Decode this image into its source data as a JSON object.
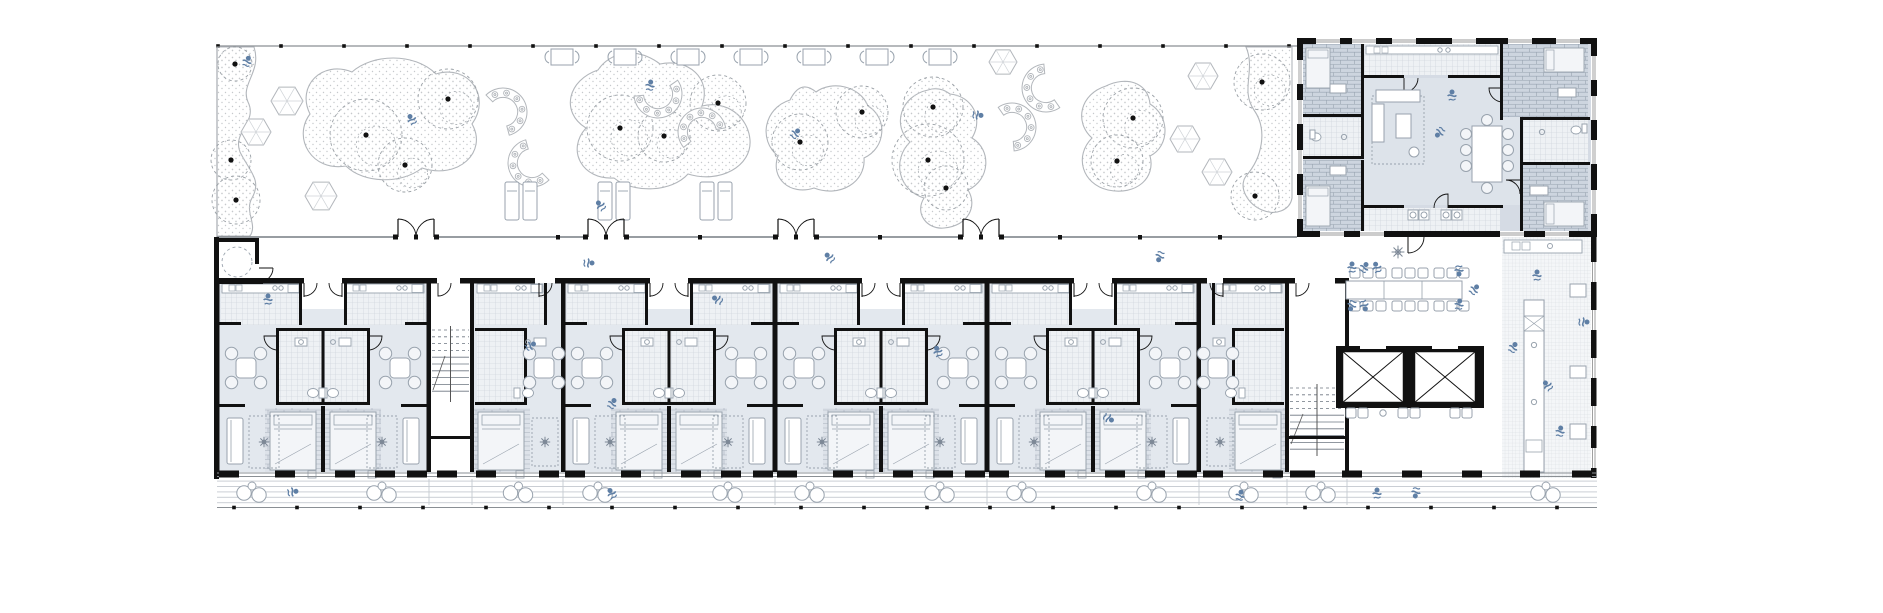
{
  "meta": {
    "drawing_type": "architectural-floor-plan",
    "storeys": "ground floor",
    "visible_text": ""
  },
  "palette": {
    "paper": "#ffffff",
    "wall": "#111111",
    "thin_line": "#8a8f94",
    "garden_line": "#b2b6bb",
    "tree_line": "#9aa0a6",
    "stipple_dot": "#c6c9cc",
    "unit_floor": "#e3e8ee",
    "tile_floor": "#eef1f4",
    "tile_grid": "#c7cdd6",
    "fine_grid": "#d6dade",
    "brick_line": "#a8b1bc",
    "brick_bg": "#dde2e9",
    "block_floor": "#d5dbe4",
    "block_brick_bg": "#cdd5df",
    "block_brick_line": "#98a3b0",
    "furniture": "#98a2ad",
    "person": "#5f7fa5",
    "deck_line": "#c5cad0"
  },
  "garden": {
    "bounds": {
      "x": 217,
      "y": 46,
      "x2": 1297,
      "y2": 237
    },
    "beds": [
      "M217,47 L254,47 C262,72 240,84 248,102 C258,122 232,132 240,152 C250,172 262,180 252,198 C244,212 258,224 250,236 L217,236 Z",
      "M352,72 C322,60 296,86 310,114 C292,138 312,172 346,166 C364,184 402,184 422,168 C458,180 488,152 472,124 C492,96 468,64 436,74 C414,52 372,54 352,72 Z",
      "M598,70 C568,80 560,112 586,128 C566,150 582,180 614,178 C634,194 672,192 688,174 C720,184 752,166 750,140 C748,116 726,100 702,106 C712,78 688,58 660,64 C636,46 610,52 598,70 Z",
      "M790,100 C764,108 758,140 778,156 C770,178 790,196 814,188 C840,198 866,182 864,158 C886,148 888,118 868,106 C860,86 832,80 816,92 C804,82 796,88 790,100 Z",
      "M928,90 C900,96 892,126 910,142 C892,160 898,190 924,198 C914,214 928,230 944,228 C968,226 978,206 968,190 C990,180 992,150 972,138 C984,118 972,96 950,94 C942,88 934,88 928,90 Z",
      "M1106,86 C1080,94 1074,122 1092,138 C1074,156 1082,184 1108,190 C1136,196 1156,178 1150,156 C1170,146 1170,116 1150,104 C1148,82 1126,76 1106,86 Z",
      "M1246,47 C1256,70 1240,90 1254,110 C1268,130 1262,158 1246,176 C1238,188 1248,204 1262,210 C1276,216 1290,210 1292,198 L1292,47 Z"
    ],
    "trees": [
      [
        235,
        64,
        17
      ],
      [
        231,
        160,
        20
      ],
      [
        236,
        200,
        24
      ],
      [
        366,
        135,
        36
      ],
      [
        448,
        99,
        30
      ],
      [
        405,
        165,
        27
      ],
      [
        620,
        128,
        33
      ],
      [
        664,
        136,
        26
      ],
      [
        718,
        103,
        28
      ],
      [
        800,
        142,
        28
      ],
      [
        862,
        112,
        26
      ],
      [
        933,
        107,
        30
      ],
      [
        928,
        160,
        36
      ],
      [
        946,
        188,
        22
      ],
      [
        1133,
        118,
        30
      ],
      [
        1117,
        161,
        26
      ],
      [
        1262,
        82,
        28
      ],
      [
        1255,
        196,
        24
      ]
    ],
    "hexes": [
      [
        287,
        101,
        16
      ],
      [
        256,
        132,
        15
      ],
      [
        321,
        196,
        16
      ],
      [
        1003,
        62,
        14
      ],
      [
        1203,
        76,
        15
      ],
      [
        1185,
        139,
        15
      ],
      [
        1217,
        172,
        15
      ]
    ],
    "benches": [
      [
        503,
        112,
        -40
      ],
      [
        532,
        163,
        140
      ],
      [
        658,
        94,
        60
      ],
      [
        702,
        132,
        235
      ],
      [
        1012,
        127,
        -30
      ],
      [
        1046,
        88,
        150
      ]
    ],
    "top_tables": {
      "y": 57,
      "xs": [
        562,
        625,
        688,
        751,
        814,
        877,
        940
      ]
    },
    "loungers": [
      [
        505,
        182
      ],
      [
        598,
        182
      ],
      [
        700,
        182
      ]
    ],
    "top_ticks": {
      "y": 46,
      "start": 218,
      "step": 63,
      "end": 1290
    }
  },
  "corridor": {
    "wall_y": 237,
    "door_xs": [
      416,
      606,
      796,
      981
    ],
    "tick_xs": [
      558,
      700,
      880,
      1060,
      1140,
      1220
    ]
  },
  "units": {
    "pair_cx": [
      323,
      669,
      881,
      1093
    ],
    "half_units": [
      {
        "x": 472,
        "w": 91,
        "side": "L"
      },
      {
        "x": 1199,
        "w": 88,
        "side": "R"
      }
    ],
    "stairs": [
      {
        "x": 429,
        "w": 43
      },
      {
        "x": 1287,
        "w": 60
      }
    ],
    "wc_room": {
      "x": 217,
      "y": 238,
      "w": 42,
      "h": 46
    }
  },
  "core": {
    "elevators": {
      "x": 1336,
      "y": 346,
      "w": 148,
      "h": 62
    },
    "bench_row": {
      "y": 408,
      "pairs": [
        1346,
        1398,
        1450
      ]
    },
    "communal_table": {
      "x": 1346,
      "y": 281,
      "w": 116,
      "h": 18,
      "chair_xs": [
        1350,
        1363,
        1376,
        1392,
        1405,
        1418,
        1434,
        1447,
        1459
      ],
      "top_y": 268,
      "bot_y": 301
    },
    "plant_xy": [
      1398,
      252
    ],
    "cafe": {
      "x": 1502,
      "y": 237,
      "w": 91,
      "h": 241,
      "wall_gap_ys": [
        262,
        310,
        358,
        406,
        448
      ]
    }
  },
  "amenity_block": {
    "x": 1297,
    "y": 38,
    "w": 300,
    "h": 199,
    "top_gap_xs": [
      1316,
      1352,
      1392,
      1452,
      1508,
      1556
    ],
    "bottom_gap_xs": [
      1320,
      1360,
      1500,
      1545
    ],
    "left_gap_ys": [
      60,
      100,
      150,
      195
    ],
    "right_gap_ys": [
      56,
      96,
      140,
      190
    ],
    "washer_xs": [
      1408,
      1419,
      1441,
      1452
    ]
  },
  "deck": {
    "y": 479,
    "h": 27,
    "x": 217,
    "x2": 1597,
    "ground_y": 507.5,
    "tick_start": 234,
    "tick_step": 63,
    "dividers": [
      429,
      472,
      563,
      775,
      987,
      1199,
      1287,
      1347
    ],
    "right_piers": [
      1290,
      1342,
      1402,
      1462,
      1520,
      1572
    ]
  },
  "people": [
    [
      247,
      62,
      20
    ],
    [
      412,
      120,
      -30
    ],
    [
      650,
      86,
      10
    ],
    [
      795,
      134,
      40
    ],
    [
      977,
      115,
      95
    ],
    [
      601,
      206,
      -40
    ],
    [
      588,
      263,
      90
    ],
    [
      830,
      258,
      -45
    ],
    [
      1160,
      256,
      200
    ],
    [
      268,
      300,
      0
    ],
    [
      530,
      346,
      60
    ],
    [
      612,
      404,
      30
    ],
    [
      938,
      352,
      -20
    ],
    [
      1108,
      418,
      120
    ],
    [
      718,
      300,
      -60
    ],
    [
      1352,
      268,
      0
    ],
    [
      1364,
      268,
      30
    ],
    [
      1377,
      268,
      -20
    ],
    [
      1459,
      270,
      180
    ],
    [
      1352,
      305,
      200
    ],
    [
      1364,
      305,
      160
    ],
    [
      1459,
      305,
      10
    ],
    [
      1474,
      290,
      40
    ],
    [
      1537,
      276,
      0
    ],
    [
      1513,
      348,
      30
    ],
    [
      1548,
      386,
      -40
    ],
    [
      1560,
      432,
      10
    ],
    [
      1583,
      322,
      90
    ],
    [
      1452,
      96,
      0
    ],
    [
      1440,
      132,
      220
    ],
    [
      292,
      492,
      80
    ],
    [
      612,
      494,
      -30
    ],
    [
      1240,
      496,
      15
    ],
    [
      1377,
      494,
      0
    ],
    [
      1416,
      492,
      190
    ]
  ]
}
